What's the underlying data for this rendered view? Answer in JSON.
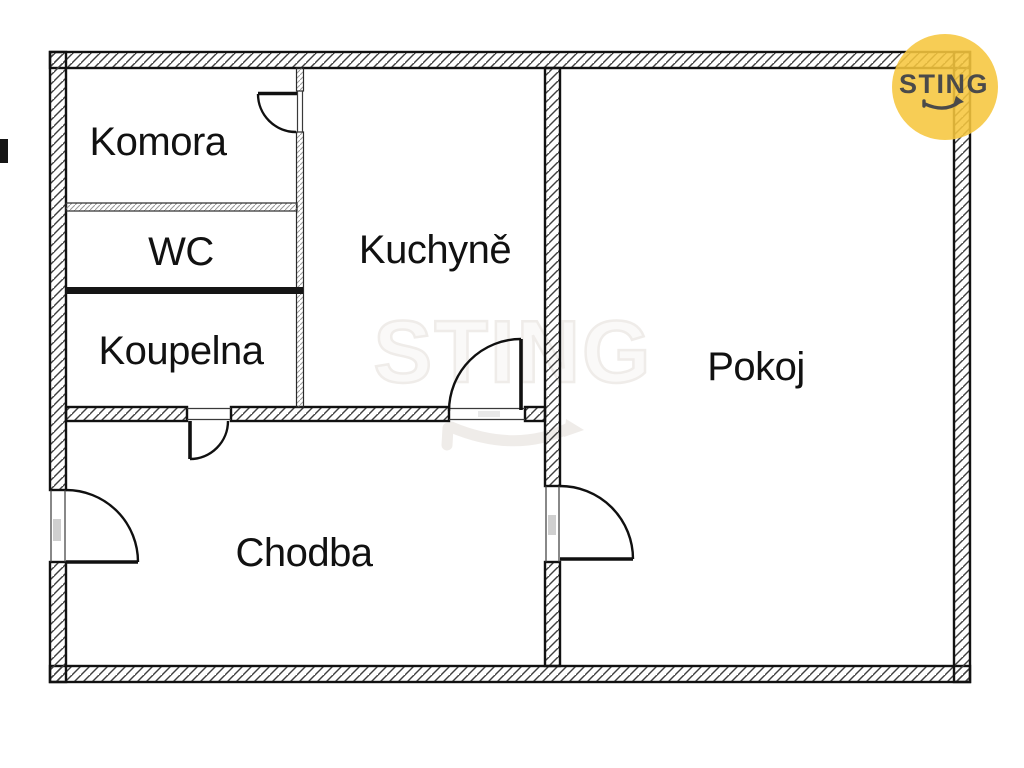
{
  "rooms": [
    {
      "id": "komora",
      "label": "Komora"
    },
    {
      "id": "wc",
      "label": "WC"
    },
    {
      "id": "koupelna",
      "label": "Koupelna"
    },
    {
      "id": "kuchyne",
      "label": "Kuchyně"
    },
    {
      "id": "pokoj",
      "label": "Pokoj"
    },
    {
      "id": "chodba",
      "label": "Chodba"
    }
  ],
  "watermark": {
    "text": "STING"
  },
  "logo": {
    "text": "STING"
  },
  "colors": {
    "accent-yellow": "#F6C63E",
    "logo-text": "#4A4A4A",
    "line": "#111111",
    "label": "#111111",
    "watermark": "#EFECE9",
    "bg": "#FFFFFF"
  }
}
